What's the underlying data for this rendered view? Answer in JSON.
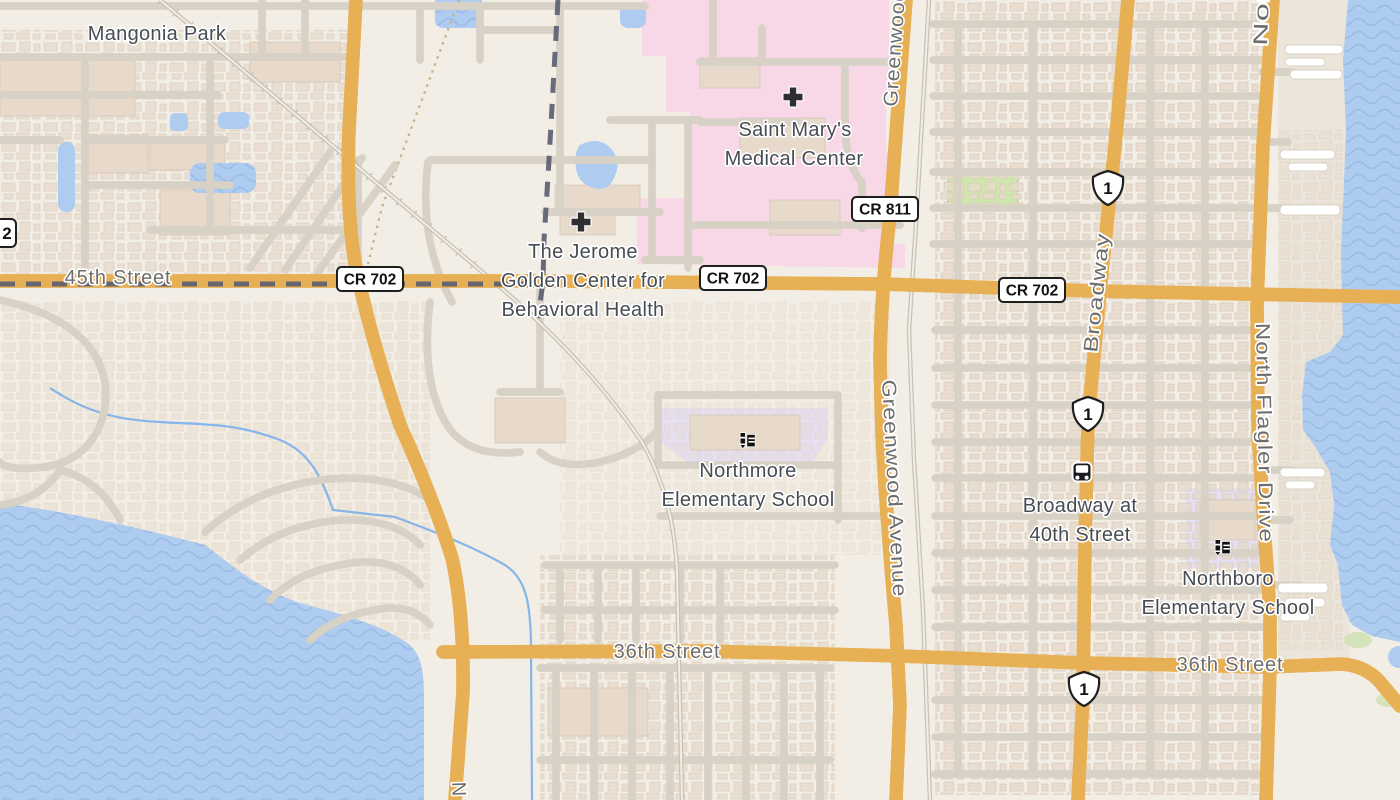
{
  "map": {
    "type": "street-map",
    "area": "West Palm Beach / Mangonia Park, FL"
  },
  "labels": {
    "places": {
      "mangonia_park": "Mangonia Park",
      "saint_marys_line1": "Saint Mary's",
      "saint_marys_line2": "Medical Center",
      "jerome_line1": "The Jerome",
      "jerome_line2": "Golden Center for",
      "jerome_line3": "Behavioral Health",
      "northmore_line1": "Northmore",
      "northmore_line2": "Elementary School",
      "broadway40_line1": "Broadway at",
      "broadway40_line2": "40th Street",
      "northboro_line1": "Northboro",
      "northboro_line2": "Elementary School"
    },
    "streets": {
      "s45": "45th Street",
      "s36_west": "36th Street",
      "s36_east": "36th Street",
      "greenwood_top": "Greenwood",
      "greenwood": "Greenwood Avenue",
      "broadway": "Broadway",
      "flagler": "North Flagler Drive",
      "flagler_top_partial": "Nor",
      "n_bottom_partial": "N"
    }
  },
  "shields": {
    "cr702": "CR 702",
    "cr811": "CR 811",
    "us1": "1",
    "sr_partial": "2"
  },
  "icons": {
    "hospital": "hospital-cross-icon",
    "school": "school-icon",
    "bus": "bus-stop-icon"
  },
  "colors": {
    "water": "#aecbf0",
    "wave": "#9abbe4",
    "land": "#f2eee5",
    "road_major_fill": "#fce9a3",
    "road_major_casing": "#e8b054",
    "road_minor_fill": "#ffffff",
    "road_minor_casing": "#d8d1c6",
    "hospital_area": "#f8d7e6",
    "school_area": "#e6dff2",
    "park": "#cfe6ad",
    "building": "#e7dacb",
    "railway": "#c8c1b5",
    "dashed_line": "#5b5f72",
    "stream": "#85b5ea",
    "label_place": "#474d54",
    "label_street": "#6e6e6e"
  }
}
